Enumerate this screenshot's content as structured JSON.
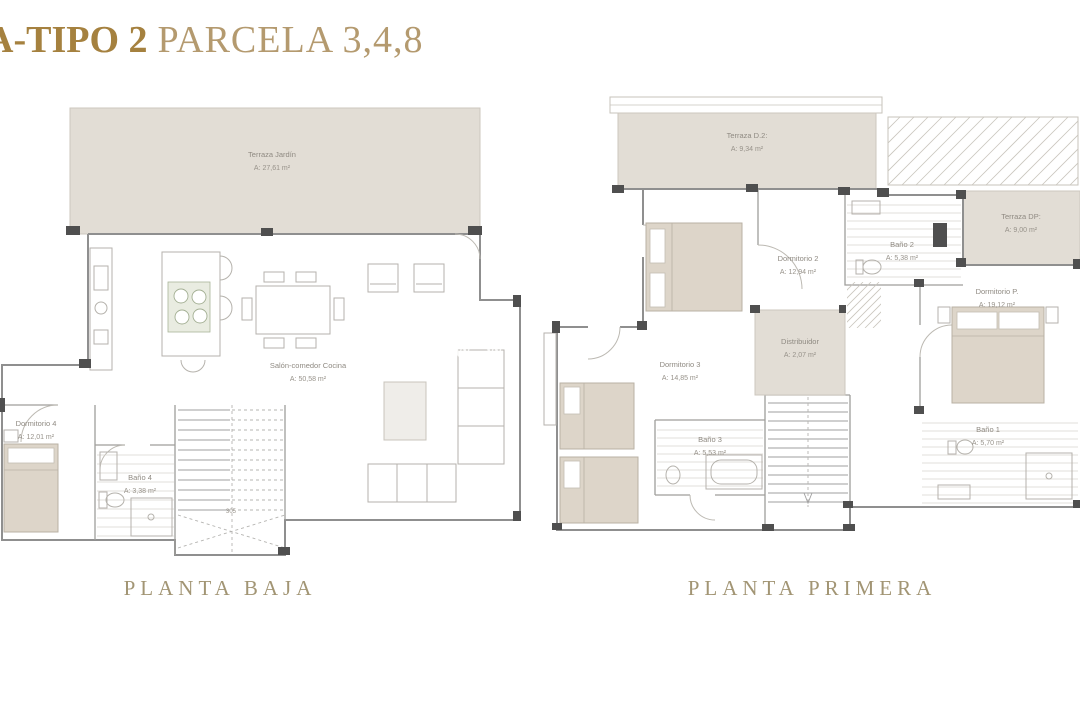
{
  "title": {
    "bold": "A-TIPO 2",
    "regular": "PARCELA 3,4,8"
  },
  "watermark": "www.",
  "plans": {
    "ground": {
      "caption": "PLANTA BAJA",
      "stair_note": "305",
      "rooms": {
        "terraza_jardin": {
          "name": "Terraza Jardín",
          "area": "A: 27,61 m²"
        },
        "salon": {
          "name": "Salón-comedor Cocina",
          "area": "A: 50,58 m²"
        },
        "dormitorio_4": {
          "name": "Dormitorio 4",
          "area": "A: 12,01 m²"
        },
        "bano_4": {
          "name": "Baño 4",
          "area": "A: 3,38 m²"
        }
      }
    },
    "first": {
      "caption": "PLANTA PRIMERA",
      "rooms": {
        "terraza_d2": {
          "name": "Terraza D.2:",
          "area": "A: 9,34 m²"
        },
        "terraza_dp": {
          "name": "Terraza DP:",
          "area": "A: 9,00 m²"
        },
        "dormitorio_2": {
          "name": "Dormitorio 2",
          "area": "A: 12,94 m²"
        },
        "bano_2": {
          "name": "Baño 2",
          "area": "A: 5,38 m²"
        },
        "dormitorio_p": {
          "name": "Dormitorio P.",
          "area": "A: 19,12 m²"
        },
        "distribuidor": {
          "name": "Distribuidor",
          "area": "A: 2,07 m²"
        },
        "dormitorio_3": {
          "name": "Dormitorio 3",
          "area": "A: 14,85 m²"
        },
        "bano_3": {
          "name": "Baño 3",
          "area": "A: 5,53 m²"
        },
        "bano_1": {
          "name": "Baño 1",
          "area": "A: 5,70 m²"
        }
      }
    }
  },
  "colors": {
    "title_gold": "#a5813f",
    "title_gold_light": "#b49a6f",
    "caption_gold": "#a29574",
    "terrace_fill": "#e2ddd5",
    "wall_gray": "#8f8f8f",
    "column_dark": "#4f4f4f",
    "bed_beige": "#ddd5c9",
    "label_gray": "#8f8a82"
  }
}
